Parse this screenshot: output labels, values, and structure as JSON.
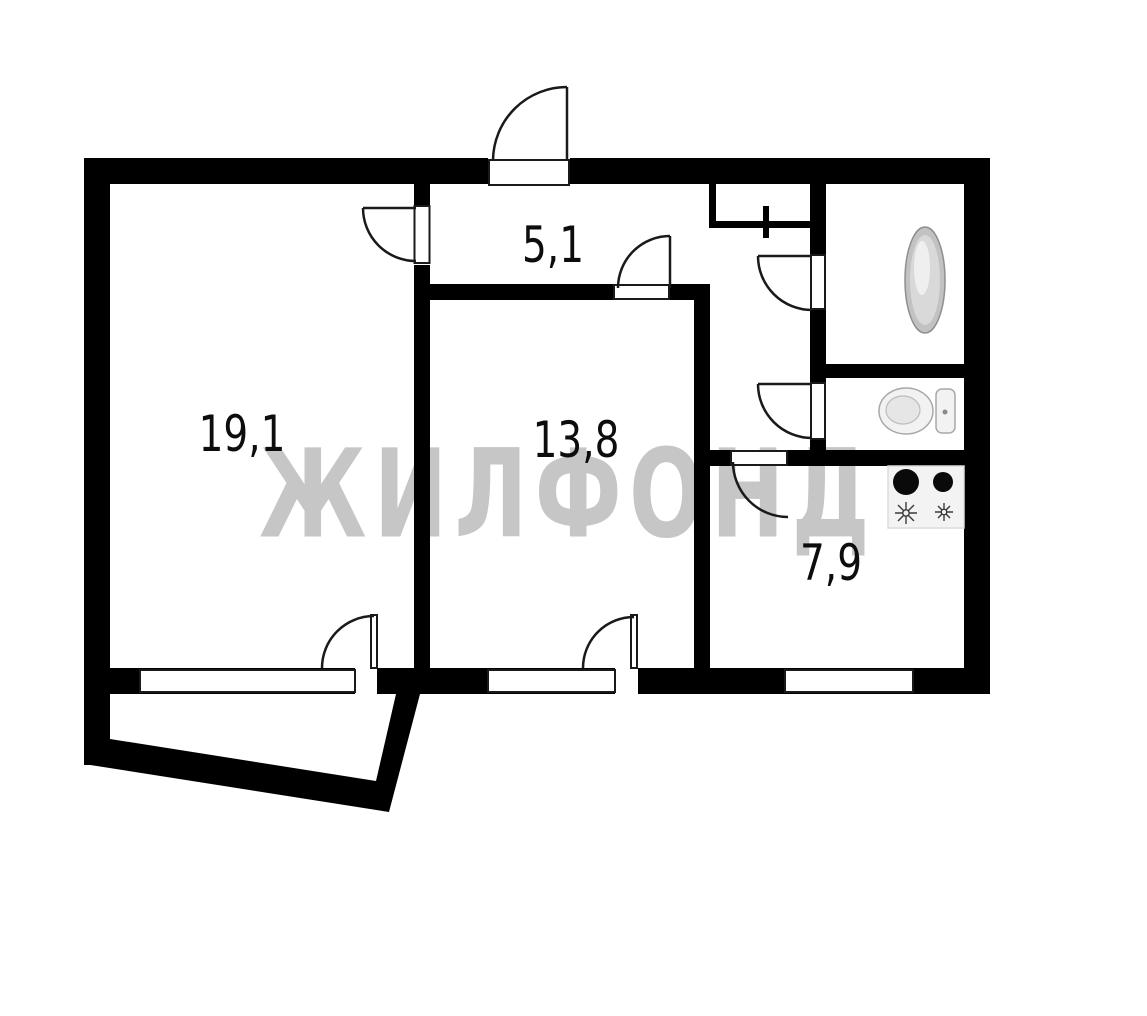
{
  "page": {
    "title": "apartment-floor-plan"
  },
  "watermark": {
    "text": "ЖИЛФОНД",
    "color": "#c6c6c6"
  },
  "rooms": [
    {
      "id": "living-room",
      "area_label": "19,1"
    },
    {
      "id": "hallway",
      "area_label": "5,1"
    },
    {
      "id": "bedroom",
      "area_label": "13,8"
    },
    {
      "id": "kitchen",
      "area_label": "7,9"
    }
  ],
  "fixtures": [
    {
      "icon": "bathtub-icon"
    },
    {
      "icon": "toilet-icon"
    },
    {
      "icon": "stove-icon"
    }
  ],
  "colors": {
    "wall": "#000000",
    "background": "#ffffff",
    "door_line": "#1a1a1a",
    "fixture_gray": "#c2c2c2"
  }
}
